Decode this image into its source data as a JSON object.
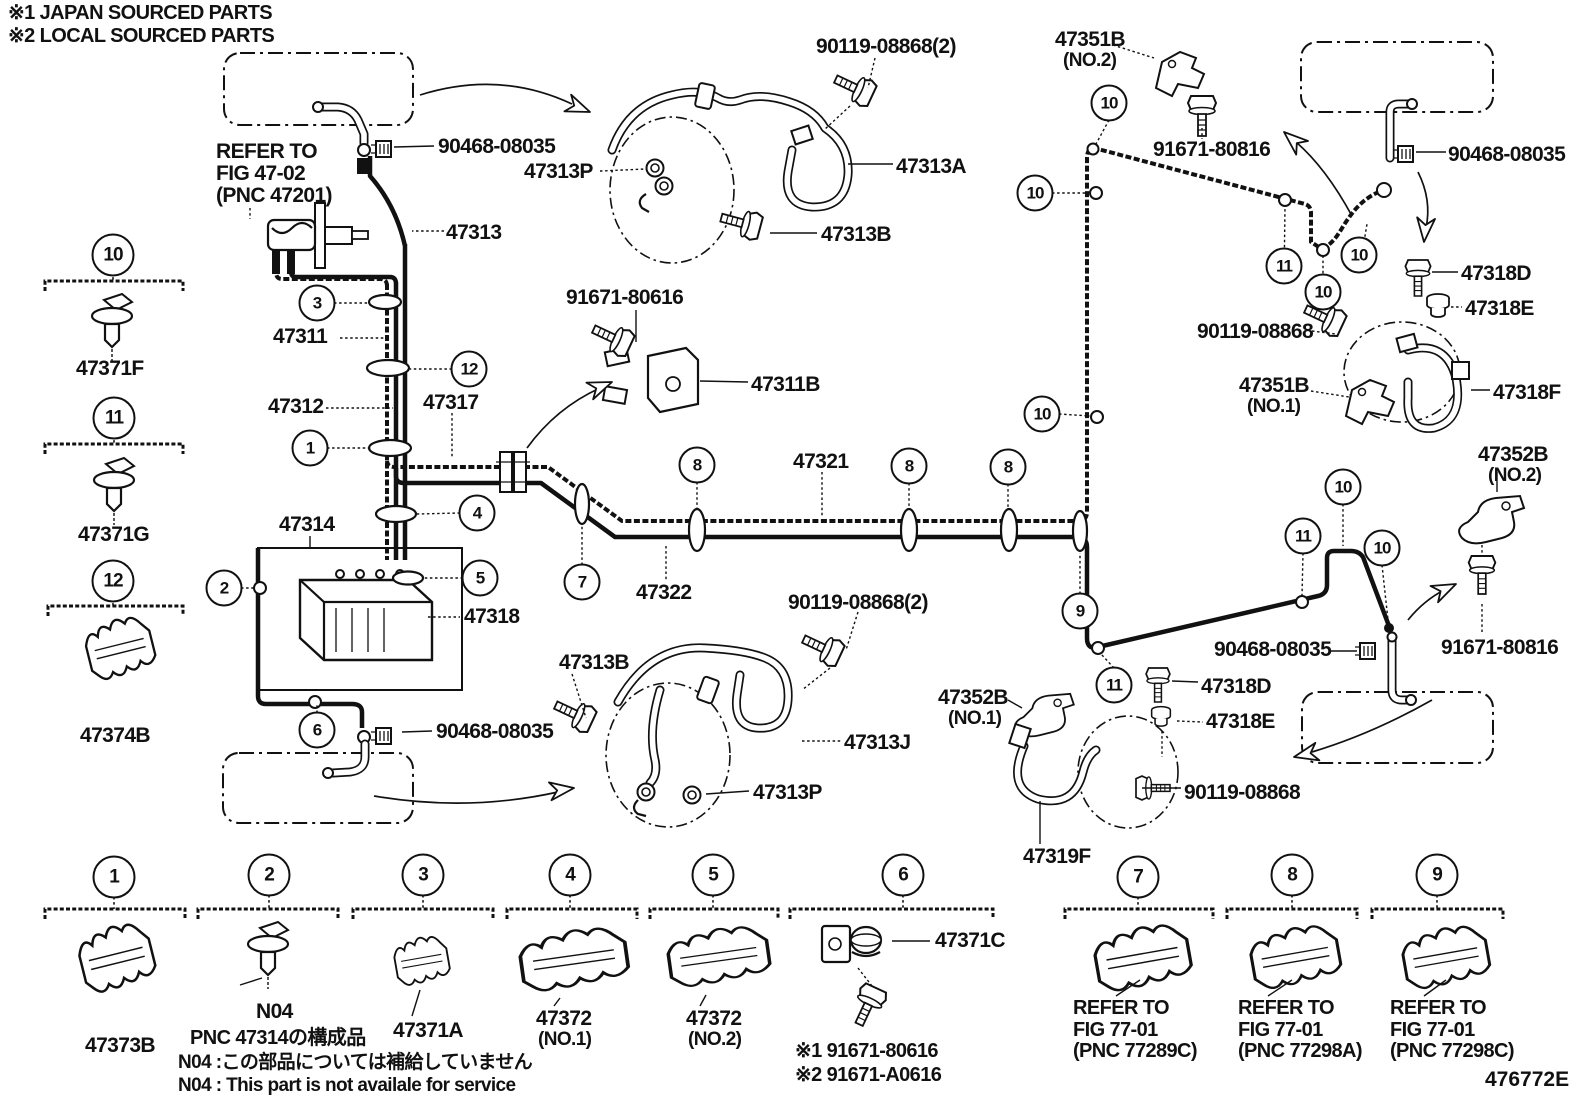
{
  "notes": {
    "line1": "※1 JAPAN SOURCED PARTS",
    "line2": "※2 LOCAL SOURCED PARTS"
  },
  "figure_code": "476772E",
  "diagram_labels": [
    {
      "id": "clamp-90468-top-left",
      "text": "90468-08035"
    },
    {
      "id": "bolt-90119-top",
      "text": "90119-08868(2)"
    },
    {
      "id": "bracket-47351b-no2",
      "text": "47351B"
    },
    {
      "id": "bracket-47351b-no2-no",
      "text": "(NO.2)"
    },
    {
      "id": "refer-fig4702-line1",
      "text": "REFER TO"
    },
    {
      "id": "refer-fig4702-line2",
      "text": "FIG 47-02"
    },
    {
      "id": "refer-fig4702-line3",
      "text": "(PNC 47201)"
    },
    {
      "id": "grommet-47313p-top",
      "text": "47313P"
    },
    {
      "id": "hose-47313a",
      "text": "47313A"
    },
    {
      "id": "bolt-91671-80816-top",
      "text": "91671-80816"
    },
    {
      "id": "clamp-90468-top-right",
      "text": "90468-08035"
    },
    {
      "id": "bolt-47313b-top",
      "text": "47313B"
    },
    {
      "id": "tube-47313",
      "text": "47313"
    },
    {
      "id": "bolt-47318d-right",
      "text": "47318D"
    },
    {
      "id": "nut-47318e-right",
      "text": "47318E"
    },
    {
      "id": "bolt-91671-80616",
      "text": "91671-80616"
    },
    {
      "id": "bolt-90119-right",
      "text": "90119-08868"
    },
    {
      "id": "tube-47311",
      "text": "47311"
    },
    {
      "id": "bracket-47351b-no1",
      "text": "47351B"
    },
    {
      "id": "bracket-47351b-no1-no",
      "text": "(NO.1)"
    },
    {
      "id": "hose-47318f",
      "text": "47318F"
    },
    {
      "id": "connector-47311b",
      "text": "47311B"
    },
    {
      "id": "tube-47312",
      "text": "47312"
    },
    {
      "id": "connector-47317",
      "text": "47317"
    },
    {
      "id": "tube-47321",
      "text": "47321"
    },
    {
      "id": "bracket-47352b-no2",
      "text": "47352B"
    },
    {
      "id": "bracket-47352b-no2-no",
      "text": "(NO.2)"
    },
    {
      "id": "tube-47314",
      "text": "47314"
    },
    {
      "id": "tube-47318",
      "text": "47318"
    },
    {
      "id": "tube-47322",
      "text": "47322"
    },
    {
      "id": "bolt-90119-bottom-center",
      "text": "90119-08868(2)"
    },
    {
      "id": "bolt-47313b-bottom",
      "text": "47313B"
    },
    {
      "id": "clamp-90468-bottom-left",
      "text": "90468-08035"
    },
    {
      "id": "hose-47313j",
      "text": "47313J"
    },
    {
      "id": "grommet-47313p-bottom",
      "text": "47313P"
    },
    {
      "id": "bracket-47352b-no1",
      "text": "47352B"
    },
    {
      "id": "bracket-47352b-no1-no",
      "text": "(NO.1)"
    },
    {
      "id": "clamp-90468-bottom-right",
      "text": "90468-08035"
    },
    {
      "id": "bolt-91671-80816-bottom",
      "text": "91671-80816"
    },
    {
      "id": "bolt-47318d-bottom",
      "text": "47318D"
    },
    {
      "id": "nut-47318e-bottom",
      "text": "47318E"
    },
    {
      "id": "bolt-90119-bottom-right",
      "text": "90119-08868"
    },
    {
      "id": "hose-47319f",
      "text": "47319F"
    }
  ],
  "callouts": [
    "3",
    "12",
    "1",
    "4",
    "2",
    "5",
    "6",
    "7",
    "8",
    "8",
    "8",
    "9",
    "10",
    "10",
    "10",
    "11",
    "10",
    "10",
    "10",
    "11",
    "10",
    "11"
  ],
  "legend_items": [
    {
      "no": "10",
      "part": "47371F"
    },
    {
      "no": "11",
      "part": "47371G"
    },
    {
      "no": "12",
      "part": "47374B"
    },
    {
      "no": "1",
      "part": "47373B"
    },
    {
      "no": "2",
      "part": "N04"
    },
    {
      "no": "3",
      "part": "47371A"
    },
    {
      "no": "4",
      "part": "47372",
      "variant": "(NO.1)"
    },
    {
      "no": "5",
      "part": "47372",
      "variant": "(NO.2)"
    },
    {
      "no": "6",
      "part": "47371C",
      "alt1": "※1 91671-80616",
      "alt2": "※2 91671-A0616"
    },
    {
      "no": "7",
      "refer1": "REFER TO",
      "refer2": "FIG 77-01",
      "refer3": "(PNC 77289C)"
    },
    {
      "no": "8",
      "refer1": "REFER TO",
      "refer2": "FIG 77-01",
      "refer3": "(PNC 77298A)"
    },
    {
      "no": "9",
      "refer1": "REFER TO",
      "refer2": "FIG 77-01",
      "refer3": "(PNC 77298C)"
    }
  ],
  "legend_notes": {
    "pnc": "PNC 47314の構成品",
    "jp": "N04 :この部品については補給していません",
    "en": "N04 : This part is not availale for service"
  }
}
